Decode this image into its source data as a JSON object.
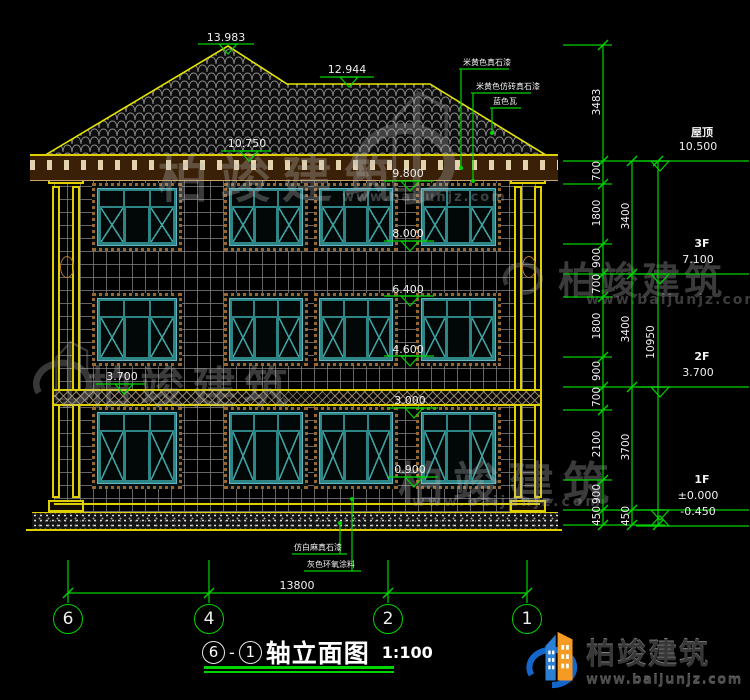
{
  "drawing_type": "building-elevation",
  "colors": {
    "background": "#000000",
    "cad_yellow": "#ded000",
    "dim_green": "#00d400",
    "window_teal": "#2e8585",
    "border_brown": "#9a6632",
    "text_white": "#f2f2f2",
    "watermark_grey": "#b9b9b9",
    "logo_blue": "#1467c8",
    "logo_orange": "#f59a23"
  },
  "elevation_markers": {
    "top": [
      "13.983",
      "12.944",
      "10.750"
    ],
    "facade": [
      "9.800",
      "8.000",
      "6.400",
      "4.600",
      "3.700",
      "3.000",
      "0.900"
    ],
    "right": [
      {
        "label": "屋顶",
        "value": "10.500"
      },
      {
        "label": "3F",
        "value": "7.100"
      },
      {
        "label": "2F",
        "value": "3.700"
      },
      {
        "label": "1F",
        "value": "±0.000"
      },
      {
        "label": "",
        "value": "-0.450"
      }
    ]
  },
  "dimensions": {
    "right_chain_inner": [
      "3483",
      "700",
      "1800",
      "900",
      "700",
      "1800",
      "900",
      "700",
      "2100",
      "900",
      "450"
    ],
    "right_chain_floors": [
      "3400",
      "3400",
      "3700",
      "450"
    ],
    "right_total": "10950",
    "bottom_total": "13800"
  },
  "axis_bubbles": [
    "6",
    "4",
    "2",
    "1"
  ],
  "material_notes": {
    "top": [
      "米黄色真石漆",
      "米黄色仿砖真石漆",
      "蓝色瓦"
    ],
    "bottom": [
      "仿白麻真石漆",
      "灰色环氧涂料"
    ]
  },
  "title_block": {
    "axis_from": "6",
    "separator": "-",
    "axis_to": "1",
    "title": "轴立面图",
    "scale": "1:100"
  },
  "watermark": {
    "name": "柏竣建筑",
    "url": "www.baijunjz.com"
  },
  "brand_logo": {
    "name": "柏竣建筑",
    "url": "www.baijunjz.com"
  }
}
